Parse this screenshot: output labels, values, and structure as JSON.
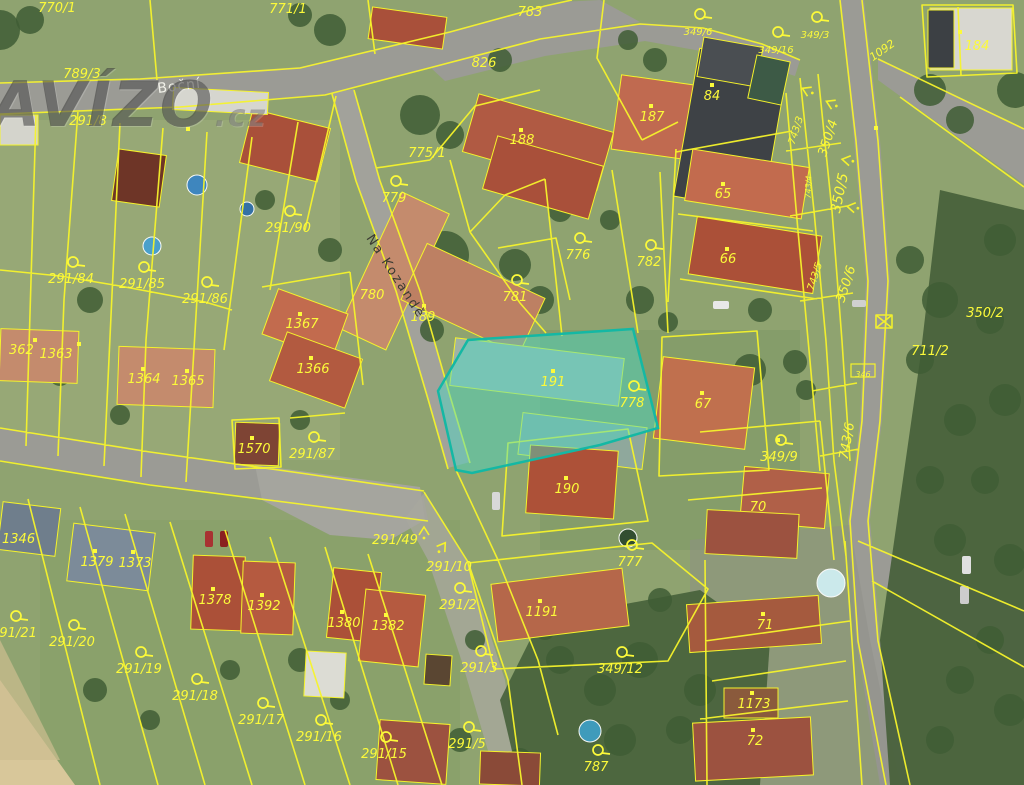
{
  "watermark": {
    "brand": "AVÍZO",
    "tld": ".cz"
  },
  "map": {
    "type": "cadastral-aerial-map",
    "highlight": {
      "parcel": "191",
      "fill": "rgba(72,219,200,0.45)",
      "stroke": "#14b8a4",
      "points": "438,391 468,340 633,329 658,428 600,445 472,473 456,470"
    },
    "colors": {
      "parcel_line": "#f6f32b",
      "label": "#fcfa3a",
      "road": "#9b9b95",
      "forest": "#46603a",
      "grass": "#8fa370"
    },
    "streets": [
      {
        "name": "Boční",
        "x": 158,
        "y": 93,
        "rot": -7,
        "size": 14,
        "color": "#f2f2ea",
        "ls": 1
      },
      {
        "name": "Na Kozandě",
        "x": 366,
        "y": 238,
        "rot": 57,
        "size": 13,
        "color": "#3b3b33",
        "ls": 2
      }
    ],
    "parcel_labels": [
      {
        "t": "770/1",
        "x": 57,
        "y": 8
      },
      {
        "t": "771/1",
        "x": 288,
        "y": 9
      },
      {
        "t": "783",
        "x": 530,
        "y": 12
      },
      {
        "t": "826",
        "x": 484,
        "y": 63
      },
      {
        "t": "789/3",
        "x": 82,
        "y": 74
      },
      {
        "t": "291/8",
        "x": 88,
        "y": 121
      },
      {
        "t": "775/1",
        "x": 427,
        "y": 153
      },
      {
        "t": "779",
        "x": 394,
        "y": 198,
        "icon": true
      },
      {
        "t": "188",
        "x": 522,
        "y": 140
      },
      {
        "t": "187",
        "x": 652,
        "y": 117
      },
      {
        "t": "84",
        "x": 712,
        "y": 96
      },
      {
        "t": "349/6",
        "x": 698,
        "y": 31,
        "s": 10,
        "icon": true
      },
      {
        "t": "349/16",
        "x": 776,
        "y": 49,
        "s": 10,
        "icon": true
      },
      {
        "t": "349/3",
        "x": 815,
        "y": 34,
        "s": 10,
        "icon": true
      },
      {
        "t": "1092",
        "x": 882,
        "y": 50,
        "s": 11,
        "r": -35
      },
      {
        "t": "184",
        "x": 977,
        "y": 46
      },
      {
        "t": "350/4",
        "x": 828,
        "y": 138,
        "r": -72
      },
      {
        "t": "743/3",
        "x": 795,
        "y": 130,
        "r": -72,
        "s": 10
      },
      {
        "t": "350/5",
        "x": 840,
        "y": 193,
        "r": -78,
        "s": 14
      },
      {
        "t": "743/4",
        "x": 807,
        "y": 187,
        "r": -88,
        "s": 8
      },
      {
        "t": "65",
        "x": 723,
        "y": 194
      },
      {
        "t": "66",
        "x": 728,
        "y": 259
      },
      {
        "t": "776",
        "x": 578,
        "y": 255,
        "icon": true
      },
      {
        "t": "782",
        "x": 649,
        "y": 262,
        "icon": true
      },
      {
        "t": "781",
        "x": 515,
        "y": 297,
        "icon": true
      },
      {
        "t": "780",
        "x": 372,
        "y": 295
      },
      {
        "t": "189",
        "x": 423,
        "y": 317
      },
      {
        "t": "291/90",
        "x": 288,
        "y": 228,
        "icon": true
      },
      {
        "t": "291/84",
        "x": 71,
        "y": 279,
        "icon": true
      },
      {
        "t": "291/85",
        "x": 142,
        "y": 284,
        "icon": true
      },
      {
        "t": "291/86",
        "x": 205,
        "y": 299,
        "icon": true
      },
      {
        "t": "1367",
        "x": 302,
        "y": 324
      },
      {
        "t": "1366",
        "x": 313,
        "y": 369
      },
      {
        "t": "362",
        "x": 9,
        "y": 350,
        "a": "s"
      },
      {
        "t": "1363",
        "x": 56,
        "y": 354
      },
      {
        "t": "1364",
        "x": 144,
        "y": 379
      },
      {
        "t": "1365",
        "x": 188,
        "y": 381
      },
      {
        "t": "1570",
        "x": 254,
        "y": 449
      },
      {
        "t": "291/87",
        "x": 312,
        "y": 454,
        "icon": true
      },
      {
        "t": "191",
        "x": 553,
        "y": 382
      },
      {
        "t": "778",
        "x": 632,
        "y": 403,
        "icon": true
      },
      {
        "t": "67",
        "x": 703,
        "y": 404
      },
      {
        "t": "190",
        "x": 567,
        "y": 489
      },
      {
        "t": "349/9",
        "x": 779,
        "y": 457,
        "icon": true
      },
      {
        "t": "743/6",
        "x": 847,
        "y": 441,
        "r": -80
      },
      {
        "t": "350/6",
        "x": 846,
        "y": 284,
        "r": -72
      },
      {
        "t": "743/5",
        "x": 814,
        "y": 276,
        "r": -72,
        "s": 10
      },
      {
        "t": "350/2",
        "x": 985,
        "y": 313
      },
      {
        "t": "711/2",
        "x": 930,
        "y": 351
      },
      {
        "t": "346",
        "x": 863,
        "y": 373,
        "s": 8,
        "box": true
      },
      {
        "t": "70",
        "x": 758,
        "y": 507
      },
      {
        "t": "71",
        "x": 765,
        "y": 625
      },
      {
        "t": "1173",
        "x": 754,
        "y": 704
      },
      {
        "t": "72",
        "x": 755,
        "y": 741
      },
      {
        "t": "777",
        "x": 630,
        "y": 562,
        "icon": true
      },
      {
        "t": "1191",
        "x": 542,
        "y": 612
      },
      {
        "t": "291/49",
        "x": 395,
        "y": 540
      },
      {
        "t": "291/10",
        "x": 449,
        "y": 567
      },
      {
        "t": "291/2",
        "x": 458,
        "y": 605,
        "icon": true
      },
      {
        "t": "291/3",
        "x": 479,
        "y": 668,
        "icon": true
      },
      {
        "t": "349/12",
        "x": 620,
        "y": 669,
        "icon": true
      },
      {
        "t": "291/5",
        "x": 467,
        "y": 744,
        "icon": true
      },
      {
        "t": "291/15",
        "x": 384,
        "y": 754,
        "icon": true
      },
      {
        "t": "291/16",
        "x": 319,
        "y": 737,
        "icon": true
      },
      {
        "t": "291/17",
        "x": 261,
        "y": 720,
        "icon": true
      },
      {
        "t": "291/18",
        "x": 195,
        "y": 696,
        "icon": true
      },
      {
        "t": "291/19",
        "x": 139,
        "y": 669,
        "icon": true
      },
      {
        "t": "291/20",
        "x": 72,
        "y": 642,
        "icon": true
      },
      {
        "t": "291/21",
        "x": 14,
        "y": 633,
        "icon": true
      },
      {
        "t": "1346",
        "x": 2,
        "y": 539,
        "a": "s"
      },
      {
        "t": "1379",
        "x": 97,
        "y": 562
      },
      {
        "t": "1373",
        "x": 135,
        "y": 563
      },
      {
        "t": "1378",
        "x": 215,
        "y": 600
      },
      {
        "t": "1392",
        "x": 264,
        "y": 606
      },
      {
        "t": "1380",
        "x": 344,
        "y": 623
      },
      {
        "t": "1382",
        "x": 388,
        "y": 626
      },
      {
        "t": "787",
        "x": 596,
        "y": 767,
        "icon": true
      }
    ],
    "buildings": [
      {
        "x": 245,
        "y": 118,
        "w": 80,
        "h": 55,
        "r": 14,
        "c": "#a9503a"
      },
      {
        "x": 173,
        "y": 90,
        "w": 95,
        "h": 22,
        "r": 3,
        "c": "#d6d6cf"
      },
      {
        "x": 115,
        "y": 152,
        "w": 48,
        "h": 52,
        "r": 8,
        "c": "#6e3527"
      },
      {
        "x": 370,
        "y": 12,
        "w": 75,
        "h": 32,
        "r": 8,
        "c": "#a9503a"
      },
      {
        "x": 468,
        "y": 112,
        "w": 140,
        "h": 60,
        "r": 16,
        "c": "#b05a43"
      },
      {
        "x": 488,
        "y": 150,
        "w": 110,
        "h": 55,
        "r": 16,
        "c": "#a9503a"
      },
      {
        "x": 616,
        "y": 80,
        "w": 80,
        "h": 75,
        "r": 8,
        "c": "#c06a50"
      },
      {
        "x": 686,
        "y": 55,
        "w": 90,
        "h": 150,
        "r": 10,
        "c": "#3e4246"
      },
      {
        "x": 700,
        "y": 42,
        "w": 60,
        "h": 40,
        "r": 10,
        "c": "#4a4e52"
      },
      {
        "x": 930,
        "y": 8,
        "w": 82,
        "h": 62,
        "r": 0,
        "c": "#d8d7d0"
      },
      {
        "x": 928,
        "y": 10,
        "w": 26,
        "h": 58,
        "r": 0,
        "c": "#3c4044"
      },
      {
        "x": 752,
        "y": 58,
        "w": 34,
        "h": 44,
        "r": 12,
        "c": "#3d5a46"
      },
      {
        "x": 688,
        "y": 158,
        "w": 118,
        "h": 52,
        "r": 9,
        "c": "#c26b4e"
      },
      {
        "x": 692,
        "y": 226,
        "w": 126,
        "h": 58,
        "r": 9,
        "c": "#ab5038"
      },
      {
        "x": 368,
        "y": 196,
        "w": 52,
        "h": 150,
        "r": 25,
        "c": "#c48b6d"
      },
      {
        "x": 408,
        "y": 268,
        "w": 130,
        "h": 62,
        "r": 25,
        "c": "#bd8063"
      },
      {
        "x": 452,
        "y": 348,
        "w": 170,
        "h": 48,
        "r": 7,
        "c": "#9fb2a6"
      },
      {
        "x": 520,
        "y": 420,
        "w": 125,
        "h": 42,
        "r": 7,
        "c": "#8fa89c"
      },
      {
        "x": 528,
        "y": 448,
        "w": 88,
        "h": 68,
        "r": 4,
        "c": "#ad5138"
      },
      {
        "x": 658,
        "y": 362,
        "w": 92,
        "h": 82,
        "r": 7,
        "c": "#c0704e"
      },
      {
        "x": 742,
        "y": 470,
        "w": 85,
        "h": 55,
        "r": 5,
        "c": "#b06048"
      },
      {
        "x": 706,
        "y": 512,
        "w": 92,
        "h": 44,
        "r": 3,
        "c": "#9c5240"
      },
      {
        "x": 235,
        "y": 423,
        "w": 44,
        "h": 42,
        "r": 2,
        "c": "#7e4434"
      },
      {
        "x": 268,
        "y": 300,
        "w": 74,
        "h": 48,
        "r": 20,
        "c": "#c26b4e"
      },
      {
        "x": 276,
        "y": 344,
        "w": 80,
        "h": 52,
        "r": 20,
        "c": "#b25a40"
      },
      {
        "x": 0,
        "y": 330,
        "w": 78,
        "h": 52,
        "r": 2,
        "c": "#c48b6d"
      },
      {
        "x": 118,
        "y": 348,
        "w": 96,
        "h": 58,
        "r": 2,
        "c": "#c48b6d"
      },
      {
        "x": 0,
        "y": 115,
        "w": 38,
        "h": 30,
        "r": 0,
        "c": "#d4d4cc"
      },
      {
        "x": 70,
        "y": 528,
        "w": 82,
        "h": 58,
        "r": 7,
        "c": "#7c8b99"
      },
      {
        "x": 0,
        "y": 505,
        "w": 58,
        "h": 48,
        "r": 7,
        "c": "#6f7e8c"
      },
      {
        "x": 192,
        "y": 556,
        "w": 52,
        "h": 74,
        "r": 2,
        "c": "#ab5038"
      },
      {
        "x": 242,
        "y": 562,
        "w": 52,
        "h": 72,
        "r": 2,
        "c": "#b55a40"
      },
      {
        "x": 330,
        "y": 570,
        "w": 48,
        "h": 70,
        "r": 6,
        "c": "#ab5038"
      },
      {
        "x": 362,
        "y": 592,
        "w": 60,
        "h": 72,
        "r": 6,
        "c": "#b55a40"
      },
      {
        "x": 494,
        "y": 576,
        "w": 132,
        "h": 58,
        "r": -7,
        "c": "#b5674a"
      },
      {
        "x": 688,
        "y": 600,
        "w": 132,
        "h": 48,
        "r": -4,
        "c": "#a55a3e"
      },
      {
        "x": 724,
        "y": 688,
        "w": 54,
        "h": 30,
        "r": 0,
        "c": "#8a5a3c"
      },
      {
        "x": 694,
        "y": 720,
        "w": 118,
        "h": 58,
        "r": -3,
        "c": "#9c5240"
      },
      {
        "x": 305,
        "y": 652,
        "w": 40,
        "h": 45,
        "r": 3,
        "c": "#dcdcd4"
      },
      {
        "x": 425,
        "y": 655,
        "w": 26,
        "h": 30,
        "r": 4,
        "c": "#5a4632"
      },
      {
        "x": 378,
        "y": 722,
        "w": 70,
        "h": 60,
        "r": 4,
        "c": "#9c5240"
      },
      {
        "x": 480,
        "y": 752,
        "w": 60,
        "h": 33,
        "r": 2,
        "c": "#8a4a38"
      }
    ],
    "building_dots": [
      [
        521,
        130
      ],
      [
        651,
        106
      ],
      [
        712,
        85
      ],
      [
        960,
        32
      ],
      [
        723,
        184
      ],
      [
        727,
        249
      ],
      [
        553,
        371
      ],
      [
        566,
        478
      ],
      [
        702,
        393
      ],
      [
        143,
        369
      ],
      [
        187,
        371
      ],
      [
        35,
        340
      ],
      [
        79,
        344
      ],
      [
        300,
        314
      ],
      [
        311,
        358
      ],
      [
        252,
        438
      ],
      [
        95,
        551
      ],
      [
        133,
        552
      ],
      [
        213,
        589
      ],
      [
        262,
        595
      ],
      [
        342,
        612
      ],
      [
        386,
        615
      ],
      [
        540,
        601
      ],
      [
        763,
        614
      ],
      [
        752,
        693
      ],
      [
        753,
        730
      ],
      [
        424,
        306
      ],
      [
        188,
        129
      ],
      [
        876,
        128
      ],
      [
        778,
        440
      ]
    ],
    "trees": [
      [
        420,
        115,
        20
      ],
      [
        450,
        135,
        14
      ],
      [
        500,
        60,
        12
      ],
      [
        445,
        255,
        24
      ],
      [
        478,
        300,
        20
      ],
      [
        515,
        265,
        16
      ],
      [
        540,
        300,
        14
      ],
      [
        432,
        330,
        12
      ],
      [
        560,
        210,
        12
      ],
      [
        610,
        220,
        10
      ],
      [
        640,
        300,
        14
      ],
      [
        668,
        322,
        10
      ],
      [
        750,
        370,
        16
      ],
      [
        795,
        362,
        12
      ],
      [
        806,
        390,
        10
      ],
      [
        90,
        300,
        13
      ],
      [
        60,
        375,
        11
      ],
      [
        120,
        415,
        10
      ],
      [
        300,
        420,
        10
      ],
      [
        330,
        250,
        12
      ],
      [
        265,
        200,
        10
      ],
      [
        740,
        100,
        14
      ],
      [
        770,
        95,
        10
      ],
      [
        745,
        250,
        12
      ],
      [
        760,
        310,
        12
      ],
      [
        930,
        90,
        16
      ],
      [
        960,
        120,
        14
      ],
      [
        910,
        260,
        14
      ],
      [
        940,
        300,
        18
      ],
      [
        920,
        360,
        14
      ],
      [
        960,
        420,
        16
      ],
      [
        930,
        480,
        14
      ],
      [
        950,
        540,
        16
      ],
      [
        700,
        690,
        16
      ],
      [
        640,
        660,
        18
      ],
      [
        600,
        690,
        16
      ],
      [
        560,
        660,
        14
      ],
      [
        680,
        730,
        14
      ],
      [
        620,
        740,
        16
      ],
      [
        580,
        600,
        12
      ],
      [
        545,
        630,
        10
      ],
      [
        660,
        600,
        12
      ],
      [
        475,
        640,
        10
      ],
      [
        300,
        660,
        12
      ],
      [
        340,
        700,
        10
      ],
      [
        95,
        690,
        12
      ],
      [
        150,
        720,
        10
      ],
      [
        230,
        670,
        10
      ],
      [
        460,
        740,
        12
      ],
      [
        520,
        760,
        12
      ],
      [
        1000,
        240,
        16
      ],
      [
        990,
        320,
        14
      ],
      [
        1005,
        400,
        16
      ],
      [
        985,
        480,
        14
      ],
      [
        1010,
        560,
        16
      ],
      [
        990,
        640,
        14
      ],
      [
        1010,
        710,
        16
      ],
      [
        960,
        680,
        14
      ],
      [
        940,
        740,
        14
      ],
      [
        1015,
        90,
        18
      ],
      [
        655,
        60,
        12
      ],
      [
        628,
        40,
        10
      ],
      [
        0,
        30,
        20
      ],
      [
        30,
        20,
        14
      ],
      [
        330,
        30,
        16
      ],
      [
        300,
        15,
        12
      ]
    ],
    "pools": [
      {
        "x": 197,
        "y": 185,
        "r": 10,
        "c": "#3a85c2"
      },
      {
        "x": 247,
        "y": 209,
        "r": 7,
        "c": "#2f6fa8"
      },
      {
        "x": 152,
        "y": 246,
        "r": 9,
        "c": "#46a0d0"
      },
      {
        "x": 831,
        "y": 583,
        "r": 14,
        "c": "#cfeef2"
      },
      {
        "x": 590,
        "y": 731,
        "r": 11,
        "c": "#3f9ec2"
      },
      {
        "x": 628,
        "y": 538,
        "r": 9,
        "c": "#2e4a2e"
      }
    ],
    "cars": [
      {
        "x": 205,
        "y": 531,
        "w": 8,
        "h": 16,
        "c": "#a83232"
      },
      {
        "x": 220,
        "y": 531,
        "w": 8,
        "h": 16,
        "c": "#8a2020"
      },
      {
        "x": 962,
        "y": 556,
        "w": 9,
        "h": 18,
        "c": "#e0e0e0"
      },
      {
        "x": 960,
        "y": 586,
        "w": 9,
        "h": 18,
        "c": "#cccccc"
      },
      {
        "x": 713,
        "y": 301,
        "w": 16,
        "h": 8,
        "c": "#e8e8e8"
      },
      {
        "x": 492,
        "y": 492,
        "w": 8,
        "h": 18,
        "c": "#d8d8d8"
      },
      {
        "x": 852,
        "y": 300,
        "w": 14,
        "h": 7,
        "c": "#d0d0d0"
      }
    ],
    "symbols": {
      "chevrons": [
        {
          "x": 806,
          "y": 90,
          "r": 115
        },
        {
          "x": 830,
          "y": 103,
          "r": 115
        },
        {
          "x": 846,
          "y": 160,
          "r": 100
        },
        {
          "x": 851,
          "y": 207,
          "r": 100
        },
        {
          "x": 424,
          "y": 531,
          "r": 180
        },
        {
          "x": 443,
          "y": 546,
          "r": 215
        }
      ],
      "xbox": {
        "x": 876,
        "y": 315,
        "w": 16,
        "h": 13
      }
    }
  }
}
